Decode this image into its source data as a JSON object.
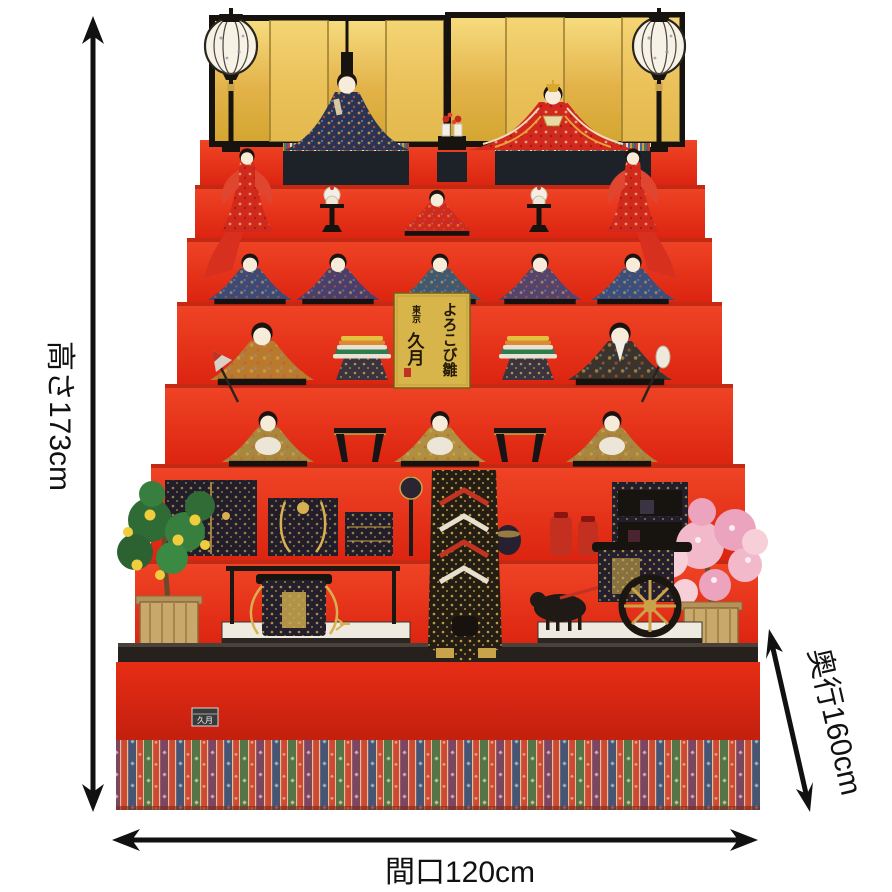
{
  "product": {
    "description_visible_text_only": true
  },
  "annotations": {
    "height_label": "高さ173cm",
    "width_label": "間口120cm",
    "depth_label": "奥行160cm"
  },
  "plaque": {
    "title": "よろこび雛",
    "city": "東京",
    "maker": "久月"
  },
  "badge": {
    "text": "久月"
  },
  "icons": {
    "vertical_arrow": "double-headed-arrow-vertical",
    "horizontal_arrow": "double-headed-arrow-horizontal",
    "diagonal_arrow": "double-headed-arrow-diagonal"
  },
  "colors": {
    "background": "#ffffff",
    "carpet_red": "#e6351c",
    "carpet_red_dark": "#c21f0e",
    "step_shadow": "#9e1406",
    "screen_gold": "#e9bc4e",
    "screen_gold_light": "#f1cd6a",
    "frame_black": "#16120d",
    "plaque_gold": "#d7b54b",
    "lantern_white": "#f6f2e6",
    "lacquer_black": "#241f2d",
    "ornament_gold": "#cfa84e",
    "tree_green": "#2f6b35",
    "fruit_yellow": "#f0cd3c",
    "blossom_pink": "#f2b9cb",
    "annotation_black": "#111111",
    "skirt_green": "#567547",
    "skirt_purple": "#7d4660",
    "skirt_navy": "#475572",
    "skirt_red": "#cc4a31"
  }
}
